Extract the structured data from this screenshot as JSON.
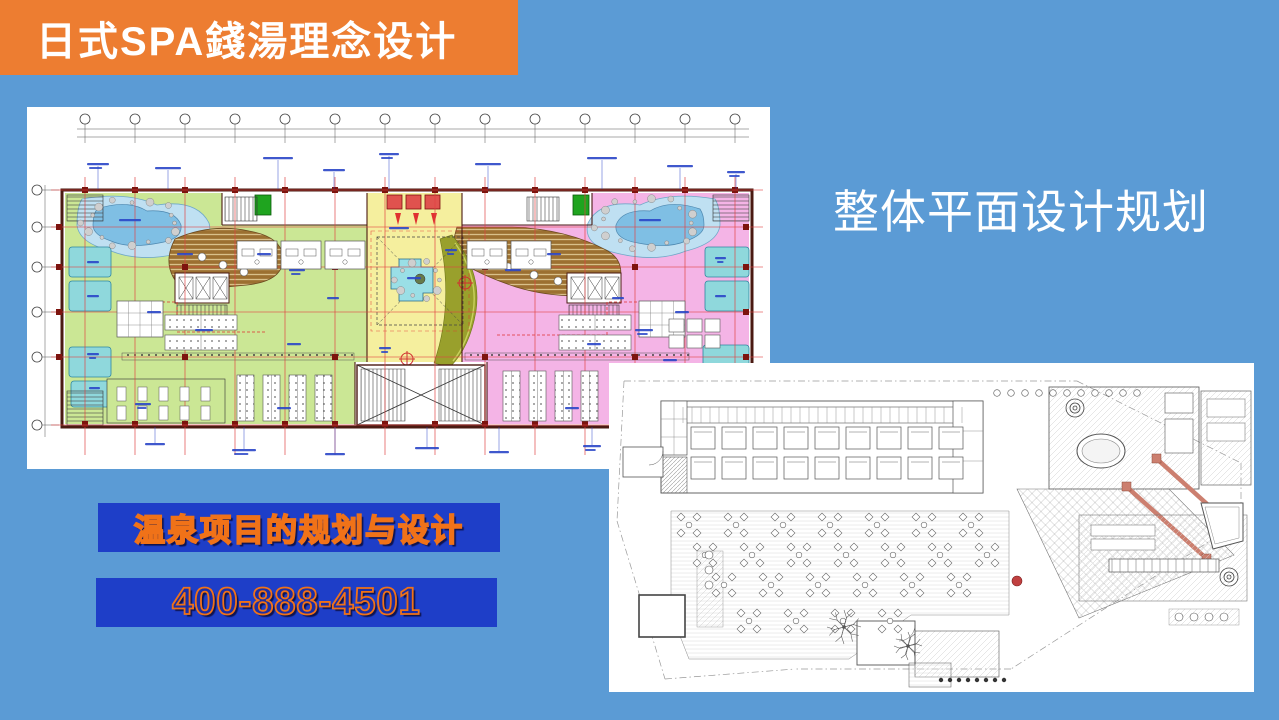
{
  "slide": {
    "background_color": "#5B9BD5",
    "header_banner": {
      "label": "日式SPA錢湯理念设计",
      "bg_color": "#ED7D31",
      "text_color": "#FFFFFF"
    },
    "section_title": {
      "label": "整体平面设计规划",
      "text_color": "#FFFFFF"
    },
    "promo_banners": {
      "bg_color": "#1E3EC8",
      "text_color": "#F07218",
      "project_label": "温泉项目的规划与设计",
      "phone_number": "400-888-4501"
    },
    "floor_plans": {
      "primary": {
        "name": "colored-bathhouse-floor-plan",
        "palette": {
          "male_zone_green": "#CBE795",
          "female_zone_pink": "#F4B4E6",
          "atrium_yellow": "#F5EF9E",
          "rock_pool_blue": "#7FBFE4",
          "bath_cyan": "#8FD8DC",
          "wood_deck_brown": "#9C7031",
          "garden_olive": "#99A02C",
          "grid_line_red": "#E04343",
          "wall_maroon": "#4A1A12",
          "annotation_blue": "#2A46C8",
          "elevator_green": "#1FA41F",
          "elevator_red": "#E0524E"
        }
      },
      "secondary": {
        "name": "monochrome-site-plan",
        "palette": {
          "line_gray": "#6E6E6E",
          "corridor_wall_salmon": "#CC7F6F",
          "accent_red": "#C04040"
        }
      }
    }
  }
}
